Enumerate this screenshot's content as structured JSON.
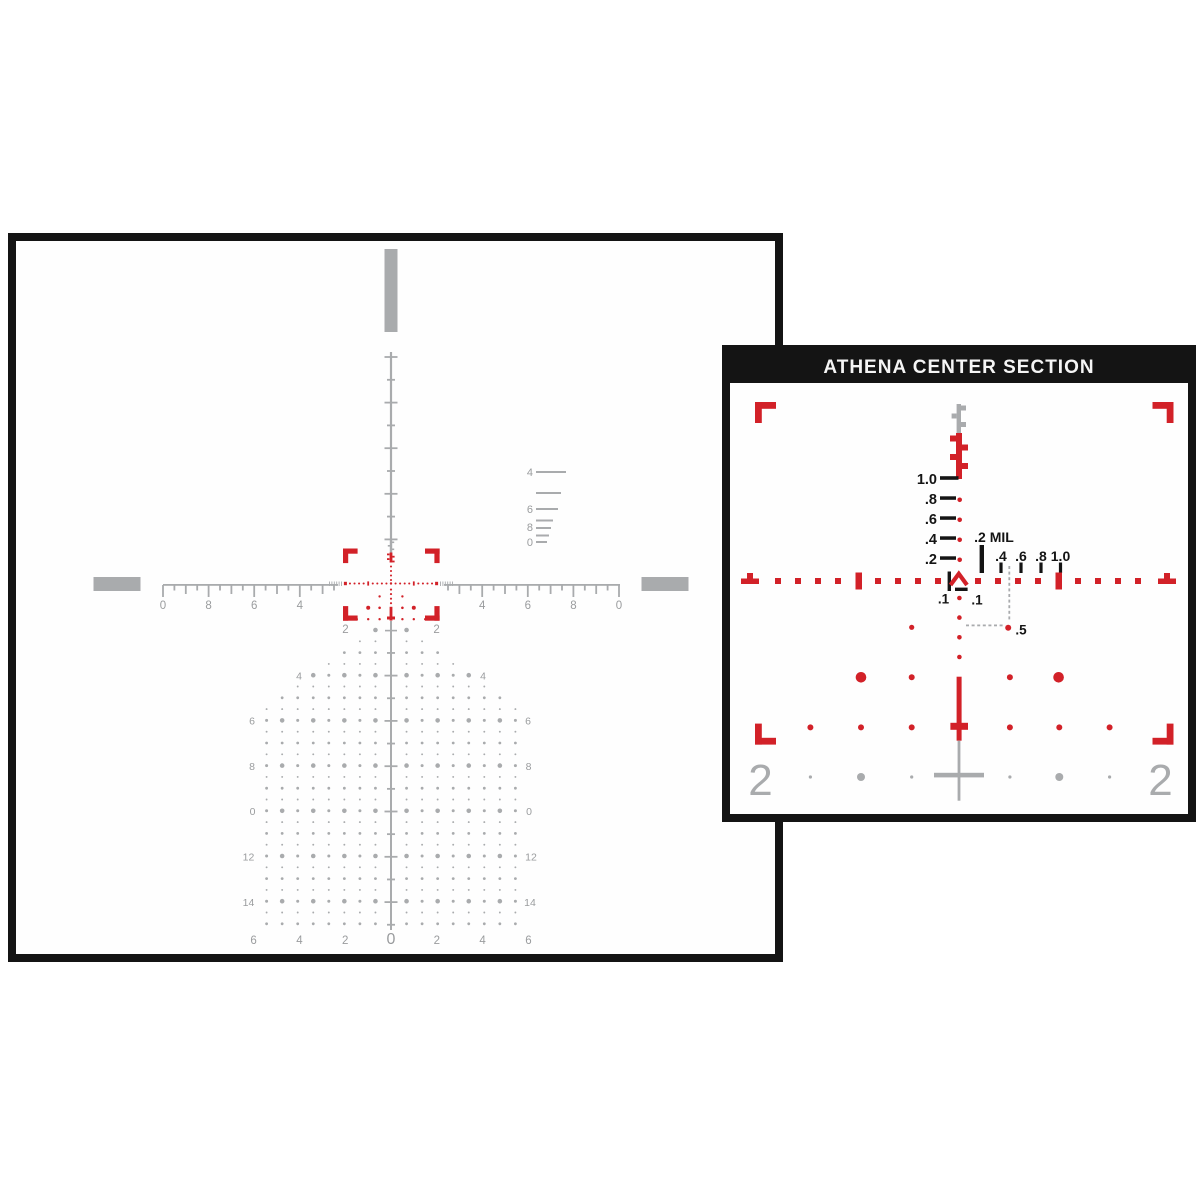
{
  "colors": {
    "red": "#d22128",
    "gray": "#a9abad",
    "label_gray": "#9a9c9e",
    "dark": "#141414",
    "title_text": "#f5f5f5"
  },
  "main_reticle": {
    "ruler_labels": [
      "0",
      "8",
      "6",
      "4",
      "2",
      "2",
      "4",
      "6",
      "8",
      "0"
    ],
    "rangefinder_labels": [
      "4",
      "6",
      "8",
      "0"
    ],
    "tree_side_labels": [
      "4",
      "6",
      "8",
      "0",
      "12",
      "14"
    ],
    "tree_bottom_labels": [
      "6",
      "4",
      "2",
      "0",
      "2",
      "4",
      "6"
    ]
  },
  "inset": {
    "title": "ATHENA CENTER SECTION",
    "elevation_labels": [
      "1.0",
      ".8",
      ".6",
      ".4",
      ".2"
    ],
    "mil_unit_label": ".2 MIL",
    "windage_labels": [
      ".4",
      ".6",
      ".8",
      "1.0"
    ],
    "tenth_labels": [
      ".1",
      ".1"
    ],
    "half_mil_label": ".5",
    "corner_labels": [
      "2",
      "2"
    ]
  }
}
